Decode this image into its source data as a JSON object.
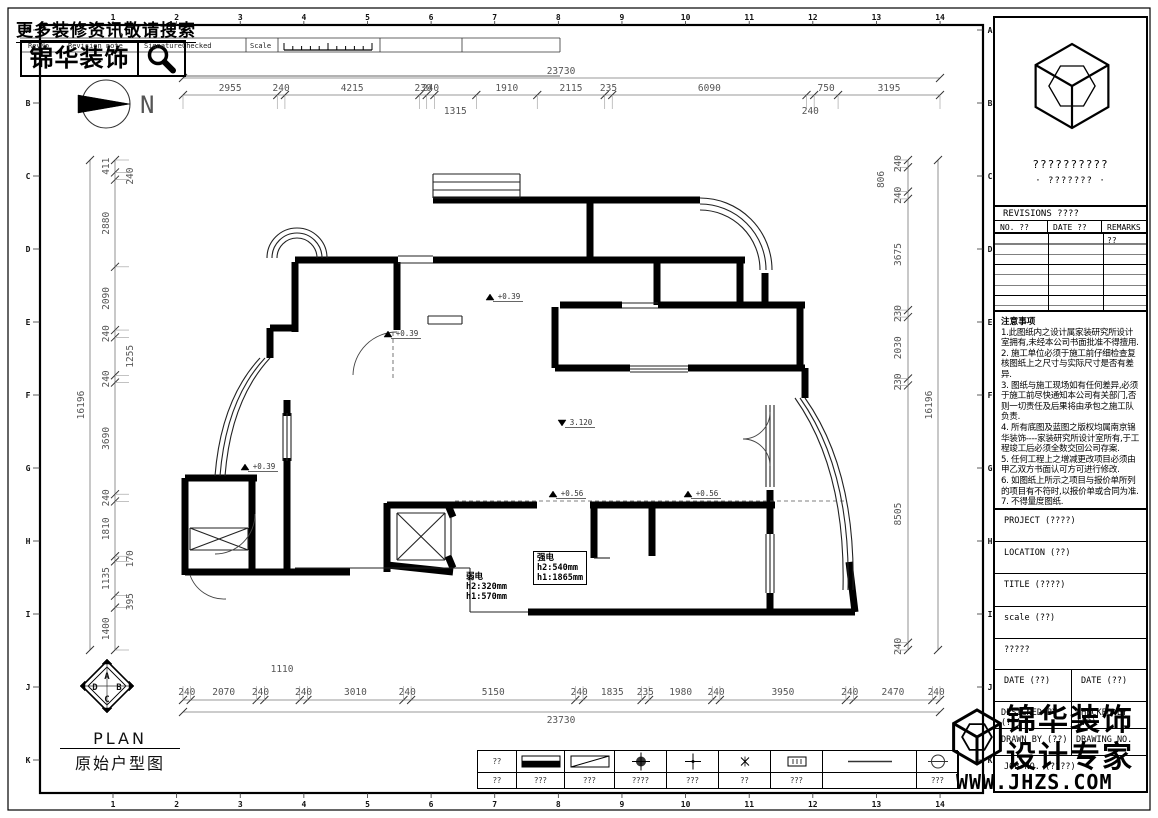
{
  "meta": {
    "width": 1158,
    "height": 818
  },
  "colors": {
    "ink": "#000000",
    "dim_text": "#555555",
    "wall": "#000000",
    "accent_bg": "#ffffff"
  },
  "header": {
    "search_hint": "更多装修资讯敬请搜索",
    "logo_text": "锦华装饰",
    "strip": {
      "rev_no": "RevNo",
      "revision_note": "Revision note",
      "signature": "Signature",
      "checked": "Checked",
      "scale": "Scale"
    },
    "north_label": "N"
  },
  "grid_refs": {
    "columns": [
      "1",
      "2",
      "3",
      "4",
      "5",
      "6",
      "7",
      "8",
      "9",
      "10",
      "11",
      "12",
      "13",
      "14"
    ],
    "rows": [
      "A",
      "B",
      "C",
      "D",
      "E",
      "F",
      "G",
      "H",
      "I",
      "J",
      "K"
    ]
  },
  "dimensions": {
    "top_total": "23730",
    "bottom_total": "23730",
    "left_total": "16196",
    "right_total": "16196",
    "top_chain": [
      {
        "v": 2955
      },
      {
        "v": 240
      },
      {
        "v": 4215
      },
      {
        "v": 230
      },
      {
        "v": 240
      },
      {
        "v": 1315,
        "row": 2
      },
      {
        "v": 1910
      },
      {
        "v": 2115
      },
      {
        "v": 235
      },
      {
        "v": 6090
      },
      {
        "v": 240,
        "row": 2
      },
      {
        "v": 750
      },
      {
        "v": 3195
      }
    ],
    "bottom_chain": [
      {
        "v": 240
      },
      {
        "v": 2070
      },
      {
        "v": 240
      },
      {
        "v": 1110,
        "row": 2
      },
      {
        "v": 240
      },
      {
        "v": 3010
      },
      {
        "v": 240
      },
      {
        "v": 5150
      },
      {
        "v": 240
      },
      {
        "v": 1835
      },
      {
        "v": 235
      },
      {
        "v": 1980
      },
      {
        "v": 240
      },
      {
        "v": 3950
      },
      {
        "v": 240
      },
      {
        "v": 2470
      },
      {
        "v": 240
      }
    ],
    "left_chain": [
      {
        "v": 411
      },
      {
        "v": 240,
        "row": 2
      },
      {
        "v": 2880
      },
      {
        "v": 2090
      },
      {
        "v": 240
      },
      {
        "v": 1255,
        "row": 2
      },
      {
        "v": 240
      },
      {
        "v": 3690
      },
      {
        "v": 240
      },
      {
        "v": 1810
      },
      {
        "v": 170,
        "row": 2
      },
      {
        "v": 1135
      },
      {
        "v": 395,
        "row": 2
      },
      {
        "v": 1400
      }
    ],
    "right_chain": [
      {
        "v": 240
      },
      {
        "v": 806,
        "row": 2
      },
      {
        "v": 240
      },
      {
        "v": 3675
      },
      {
        "v": 230
      },
      {
        "v": 2030
      },
      {
        "v": 230
      },
      {
        "v": 8505
      },
      {
        "v": 240
      }
    ]
  },
  "plan": {
    "levels": [
      {
        "x": 393,
        "y": 337,
        "text": "+0.39",
        "dir": "up"
      },
      {
        "x": 250,
        "y": 470,
        "text": "+0.39",
        "dir": "up"
      },
      {
        "x": 495,
        "y": 300,
        "text": "+0.39",
        "dir": "up"
      },
      {
        "x": 558,
        "y": 497,
        "text": "+0.56",
        "dir": "up"
      },
      {
        "x": 693,
        "y": 497,
        "text": "+0.56",
        "dir": "up"
      },
      {
        "x": 567,
        "y": 426,
        "text": "3.120",
        "dir": "down"
      }
    ],
    "electric_weak": {
      "title": "弱电",
      "line1": "h2:320mm",
      "line2": "h1:570mm"
    },
    "electric_strong": {
      "title": "强电",
      "line1": "h2:540mm",
      "line2": "h1:1865mm"
    }
  },
  "floor_plan": {
    "walls": [
      [
        433,
        200,
        700,
        200
      ],
      [
        590,
        203,
        590,
        257
      ],
      [
        295,
        260,
        398,
        260
      ],
      [
        433,
        260,
        657,
        260
      ],
      [
        657,
        260,
        745,
        260
      ],
      [
        295,
        262,
        295,
        332
      ],
      [
        270,
        328,
        295,
        328
      ],
      [
        270,
        328,
        270,
        358
      ],
      [
        397,
        262,
        397,
        330
      ],
      [
        657,
        262,
        657,
        305
      ],
      [
        740,
        262,
        740,
        305
      ],
      [
        560,
        305,
        622,
        305
      ],
      [
        658,
        305,
        805,
        305
      ],
      [
        555,
        307,
        555,
        368
      ],
      [
        555,
        368,
        630,
        368
      ],
      [
        688,
        368,
        805,
        368
      ],
      [
        765,
        273,
        765,
        305
      ],
      [
        800,
        305,
        800,
        368
      ],
      [
        805,
        368,
        805,
        398
      ],
      [
        287,
        400,
        287,
        416
      ],
      [
        287,
        458,
        287,
        477
      ],
      [
        185,
        478,
        257,
        478
      ],
      [
        185,
        478,
        185,
        575
      ],
      [
        252,
        478,
        252,
        575
      ],
      [
        185,
        572,
        350,
        572
      ],
      [
        287,
        477,
        287,
        572
      ],
      [
        387,
        503,
        387,
        572
      ],
      [
        387,
        565,
        453,
        572
      ],
      [
        387,
        505,
        537,
        505
      ],
      [
        590,
        505,
        775,
        505
      ],
      [
        594,
        508,
        594,
        558
      ],
      [
        652,
        508,
        652,
        556
      ],
      [
        770,
        490,
        770,
        534
      ],
      [
        770,
        593,
        770,
        614
      ],
      [
        528,
        612,
        855,
        612
      ],
      [
        849,
        562,
        855,
        612
      ],
      [
        448,
        505,
        453,
        517
      ],
      [
        448,
        556,
        453,
        568
      ]
    ],
    "thin": [
      [
        295,
        568,
        470,
        568
      ],
      [
        470,
        568,
        470,
        612
      ],
      [
        470,
        612,
        528,
        612
      ],
      [
        428,
        316,
        462,
        316
      ],
      [
        428,
        324,
        462,
        324
      ],
      [
        428,
        316,
        428,
        324
      ],
      [
        462,
        316,
        462,
        324
      ],
      [
        397,
        513,
        445,
        513
      ],
      [
        397,
        560,
        445,
        560
      ],
      [
        397,
        513,
        397,
        560
      ],
      [
        445,
        513,
        445,
        560
      ],
      [
        397,
        513,
        445,
        560
      ],
      [
        397,
        560,
        445,
        513
      ],
      [
        190,
        528,
        248,
        528
      ],
      [
        190,
        550,
        248,
        550
      ],
      [
        190,
        528,
        190,
        550
      ],
      [
        248,
        528,
        248,
        550
      ],
      [
        190,
        528,
        248,
        550
      ],
      [
        190,
        550,
        248,
        528
      ],
      [
        451,
        517,
        451,
        556
      ],
      [
        594,
        558,
        610,
        558
      ],
      [
        433,
        174,
        520,
        174
      ],
      [
        433,
        182,
        520,
        182
      ],
      [
        433,
        190,
        520,
        190
      ],
      [
        433,
        198,
        520,
        198
      ],
      [
        433,
        174,
        433,
        198
      ],
      [
        520,
        174,
        520,
        198
      ],
      [
        398,
        256,
        433,
        256
      ],
      [
        398,
        263,
        433,
        263
      ],
      [
        283,
        413,
        283,
        461
      ],
      [
        287,
        413,
        287,
        461
      ],
      [
        291,
        413,
        291,
        461
      ],
      [
        622,
        303,
        658,
        303
      ],
      [
        622,
        308,
        658,
        308
      ],
      [
        630,
        366,
        688,
        366
      ],
      [
        630,
        369,
        688,
        369
      ],
      [
        630,
        372,
        688,
        372
      ],
      [
        766,
        405,
        766,
        487
      ],
      [
        770,
        405,
        770,
        487
      ],
      [
        774,
        405,
        774,
        487
      ],
      [
        766,
        534,
        766,
        593
      ],
      [
        770,
        534,
        770,
        593
      ],
      [
        774,
        534,
        774,
        593
      ]
    ],
    "arcs": [
      "M267,258 A30,30 0 0 1 327,258",
      "M272,258 A25,25 0 0 1 322,258",
      "M277,258 A20,20 0 0 1 317,258",
      "M700,198 A72,72 0 0 1 772,270",
      "M700,204 A66,66 0 0 1 766,270",
      "M700,210 A60,60 0 0 1 760,270",
      "M270,358 Q231,400 225,476",
      "M265,358 Q226,400 220,476",
      "M260,358 Q221,400 215,476",
      "M805,398 Q856,470 853,590",
      "M800,398 Q851,470 848,590",
      "M795,398 Q846,470 843,590"
    ],
    "doors": [
      "M255,514 A40,40 0 0 1 215,554",
      "M397,332 A44,44 0 0 0 353,375",
      "M770,412 A27,27 0 0 1 743,439",
      "M770,466 A27,27 0 0 0 743,439",
      "M190,575 A36,36 0 0 0 226,599"
    ],
    "dashed": [
      [
        393,
        332,
        393,
        378
      ],
      [
        455,
        501,
        845,
        501
      ]
    ]
  },
  "title_block": {
    "company_placeholder": "??????????",
    "company_sub": "· ??????? ·",
    "revisions_title": "REVISIONS ????",
    "rev_cols": [
      "NO. ??",
      "DATE ??",
      "REMARKS ??"
    ],
    "notes_title": "注意事项",
    "notes": [
      "1.此图纸内之设计属家装研究所设计室拥有,未经本公司书面批准不得擅用.",
      "2. 施工单位必须于施工前仔细检查复核图纸上之尺寸与实际尺寸是否有差异.",
      "3. 图纸与施工现场如有任何差异,必须于施工前尽快通知本公司有关部门,否则一切责任及后果将由承包之施工队负责.",
      "4. 所有底图及蓝图之版权均属南京锦华装饰----家装研究所设计室所有,于工程竣工后必须全数交回公司存案.",
      "5. 任何工程上之增减更改项目必须由甲乙双方书面认可方可进行修改.",
      "6. 如图纸上所示之项目与报价单所列的项目有不符时,以报价单或合同为准.",
      "7. 不得量度图纸."
    ],
    "project": "PROJECT (????)",
    "location": "LOCATION (??)",
    "title": "TITLE (????)",
    "scale": "scale (??)",
    "unknown": "?????",
    "date_left": "DATE (??)",
    "date_right": "DATE (??)",
    "designed_by": "DESIGNED BY (??)",
    "checked_by": "CHECKED BY (??)",
    "drawn_by": "DRAWN BY (??)",
    "drawing_no": "DRAWING NO.",
    "job_no": "JOB NO. (????)"
  },
  "brand": {
    "name": "锦华装饰",
    "tagline": "设计专家",
    "website": "WWW.JHZS.COM"
  },
  "plan_title": {
    "en": "PLAN",
    "zh": "原始户型图",
    "key": [
      "A",
      "B",
      "C",
      "D"
    ]
  },
  "legend": {
    "cells": [
      {
        "sym": "text",
        "label": "??",
        "sub": "??"
      },
      {
        "sym": "bar",
        "sub": "???"
      },
      {
        "sym": "rect-diag",
        "sub": "???"
      },
      {
        "sym": "target",
        "sub": "????"
      },
      {
        "sym": "cross",
        "sub": "???"
      },
      {
        "sym": "star",
        "sub": "??"
      },
      {
        "sym": "meter",
        "sub": "???"
      },
      {
        "sym": "dash",
        "sub": ""
      },
      {
        "sym": "circle-minus",
        "sub": "???"
      }
    ]
  }
}
